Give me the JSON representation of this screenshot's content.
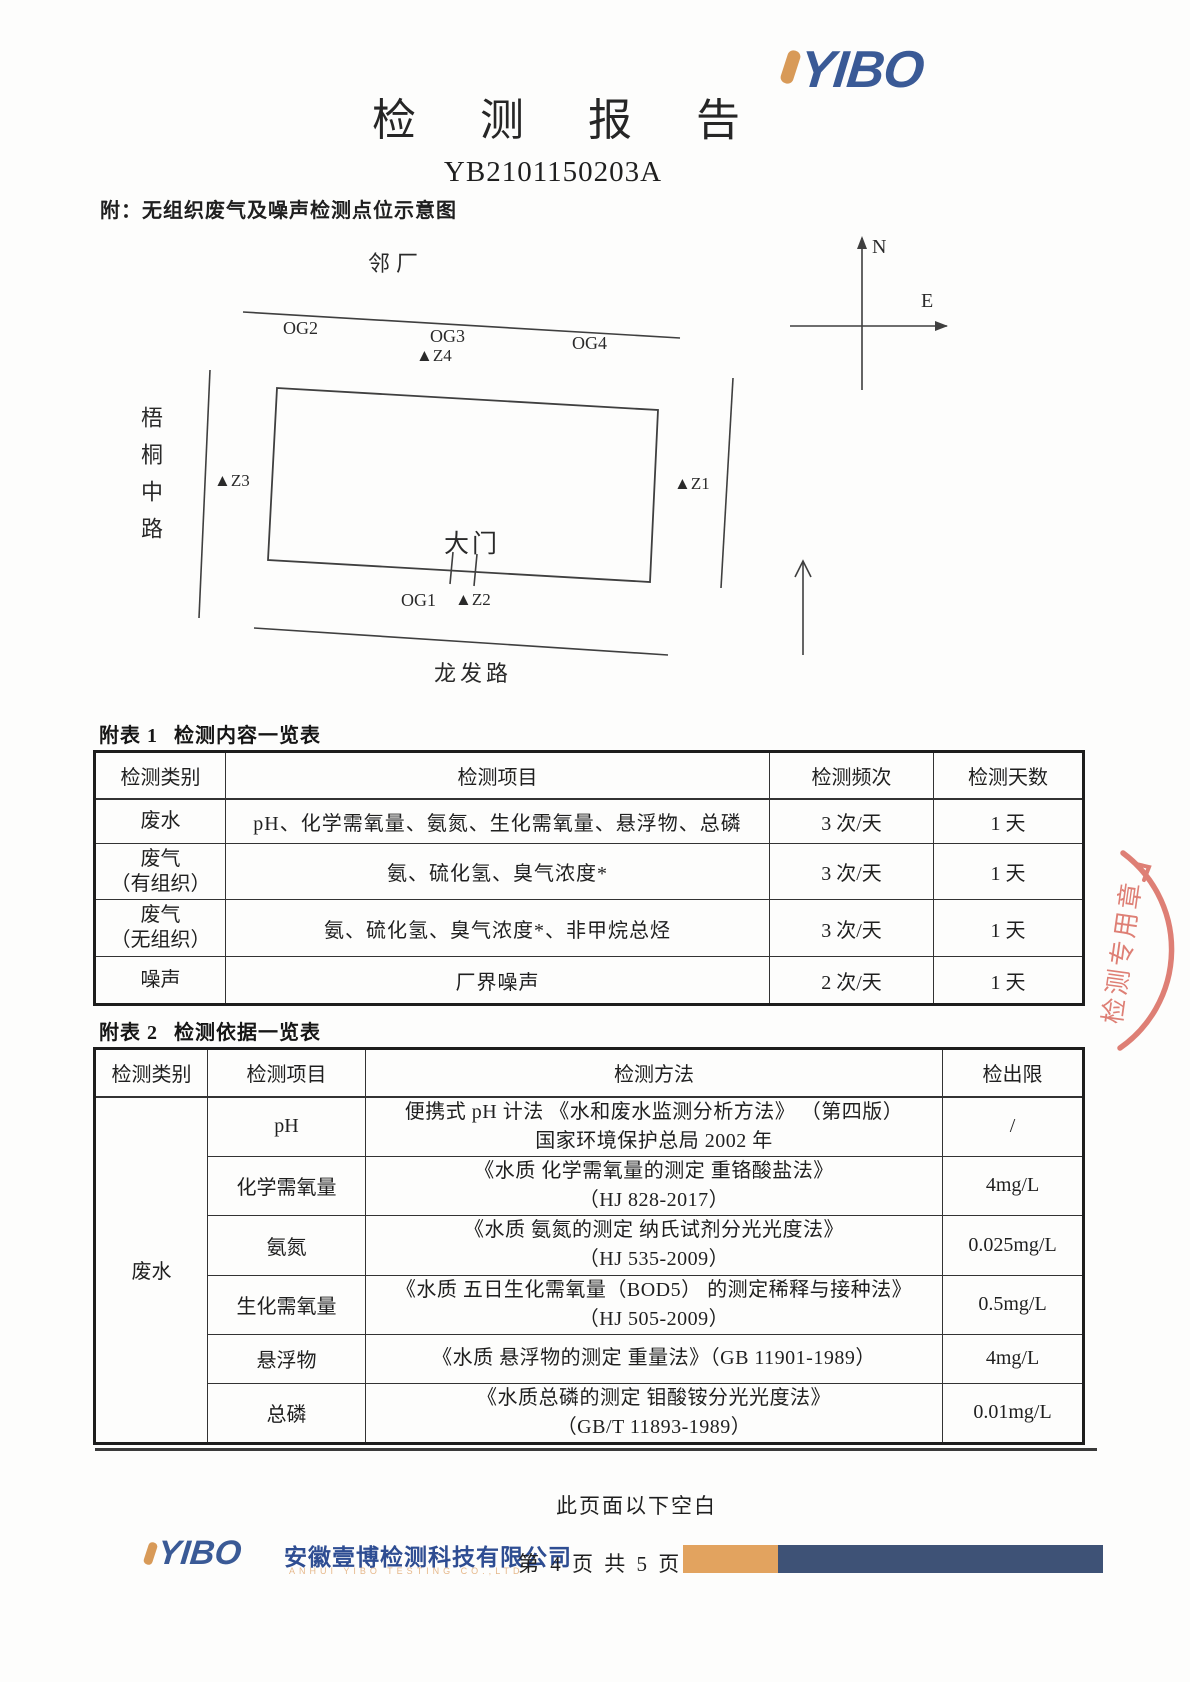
{
  "page": {
    "title": "检测报告",
    "report_no": "YB2101150203A",
    "attachment_note": "附：无组织废气及噪声检测点位示意图",
    "below_blank_note": "此页面以下空白"
  },
  "logo": {
    "text": "YIBO"
  },
  "diagram": {
    "north_label": "N",
    "east_label": "E",
    "neighbor_label": "邻厂",
    "road_left": "梧桐中路",
    "road_bottom": "龙发路",
    "gate_label": "大门",
    "og1": "OG1",
    "og2": "OG2",
    "og3": "OG3",
    "og4": "OG4",
    "z1": "▲Z1",
    "z2": "▲Z2",
    "z3": "▲Z3",
    "z4": "▲Z4"
  },
  "table1": {
    "caption_label": "附表 1",
    "caption_text": "检测内容一览表",
    "headers": [
      "检测类别",
      "检测项目",
      "检测频次",
      "检测天数"
    ],
    "rows": [
      {
        "category": "废水",
        "category2": "",
        "items": "pH、化学需氧量、氨氮、生化需氧量、悬浮物、总磷",
        "freq": "3 次/天",
        "days": "1 天"
      },
      {
        "category": "废气",
        "category2": "（有组织）",
        "items": "氨、硫化氢、臭气浓度*",
        "freq": "3 次/天",
        "days": "1 天"
      },
      {
        "category": "废气",
        "category2": "（无组织）",
        "items": "氨、硫化氢、臭气浓度*、非甲烷总烃",
        "freq": "3 次/天",
        "days": "1 天"
      },
      {
        "category": "噪声",
        "category2": "",
        "items": "厂界噪声",
        "freq": "2 次/天",
        "days": "1 天"
      }
    ]
  },
  "table2": {
    "caption_label": "附表 2",
    "caption_text": "检测依据一览表",
    "headers": [
      "检测类别",
      "检测项目",
      "检测方法",
      "检出限"
    ],
    "category_merged": "废水",
    "rows": [
      {
        "item": "pH",
        "method1": "便携式 pH 计法 《水和废水监测分析方法》 （第四版）",
        "method2": "国家环境保护总局 2002 年",
        "limit": "/"
      },
      {
        "item": "化学需氧量",
        "method1": "《水质 化学需氧量的测定 重铬酸盐法》",
        "method2": "（HJ 828-2017）",
        "limit": "4mg/L"
      },
      {
        "item": "氨氮",
        "method1": "《水质 氨氮的测定 纳氏试剂分光光度法》",
        "method2": "（HJ 535-2009）",
        "limit": "0.025mg/L"
      },
      {
        "item": "生化需氧量",
        "method1": "《水质 五日生化需氧量（BOD5） 的测定稀释与接种法》",
        "method2": "（HJ 505-2009）",
        "limit": "0.5mg/L"
      },
      {
        "item": "悬浮物",
        "method1": "《水质 悬浮物的测定 重量法》（GB 11901-1989）",
        "method2": "",
        "limit": "4mg/L"
      },
      {
        "item": "总磷",
        "method1": "《水质总磷的测定 钼酸铵分光光度法》",
        "method2": "（GB/T 11893-1989）",
        "limit": "0.01mg/L"
      }
    ]
  },
  "stamp": {
    "text": "检测专用章"
  },
  "footer": {
    "company_cn": "安徽壹博检测科技有限公司",
    "company_en": "ANHUI YIBO TESTING CO.,LTD",
    "page_indicator": "第 4 页 共 5 页"
  },
  "colors": {
    "logo_blue": "#3a5a96",
    "logo_orange": "#d89a58",
    "bar_blue": "#3e5276",
    "bar_orange": "#e2a35f",
    "stamp_red": "#d96a5e"
  }
}
